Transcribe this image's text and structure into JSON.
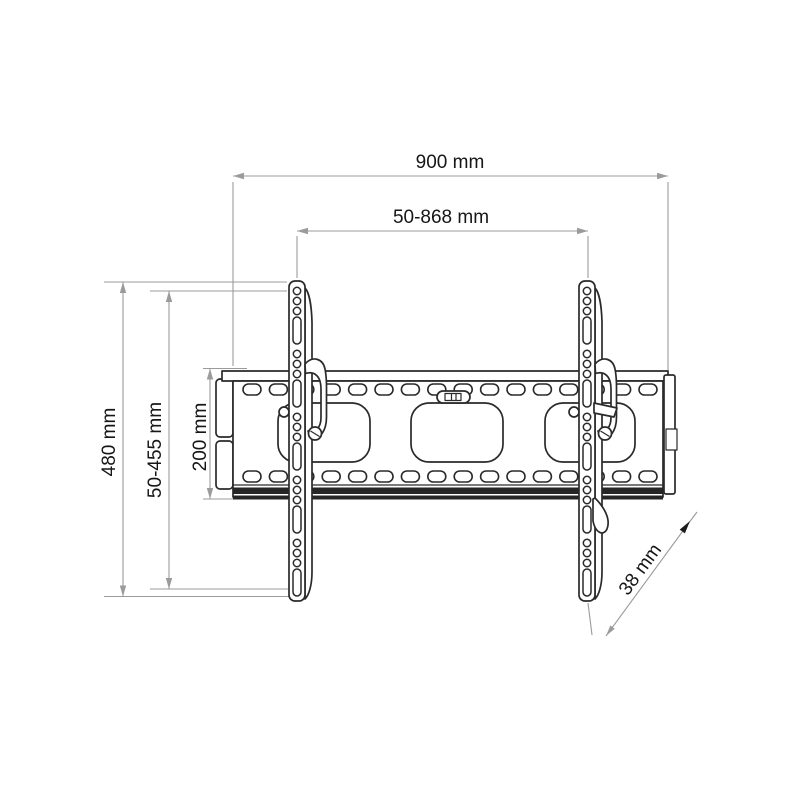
{
  "diagram": {
    "subject": "Tilting TV wall mount bracket - dimensioned technical line drawing",
    "background_color": "#ffffff",
    "drawing_line_color": "#2a2a2a",
    "dimension_line_color": "#9b9b9b",
    "label_color": "#161616",
    "labels": {
      "total_width": "900 mm",
      "mount_width_range": "50-868 mm",
      "total_height": "480 mm",
      "mount_height_range": "50-455 mm",
      "wall_plate_height": "200 mm",
      "depth": "38 mm"
    }
  }
}
